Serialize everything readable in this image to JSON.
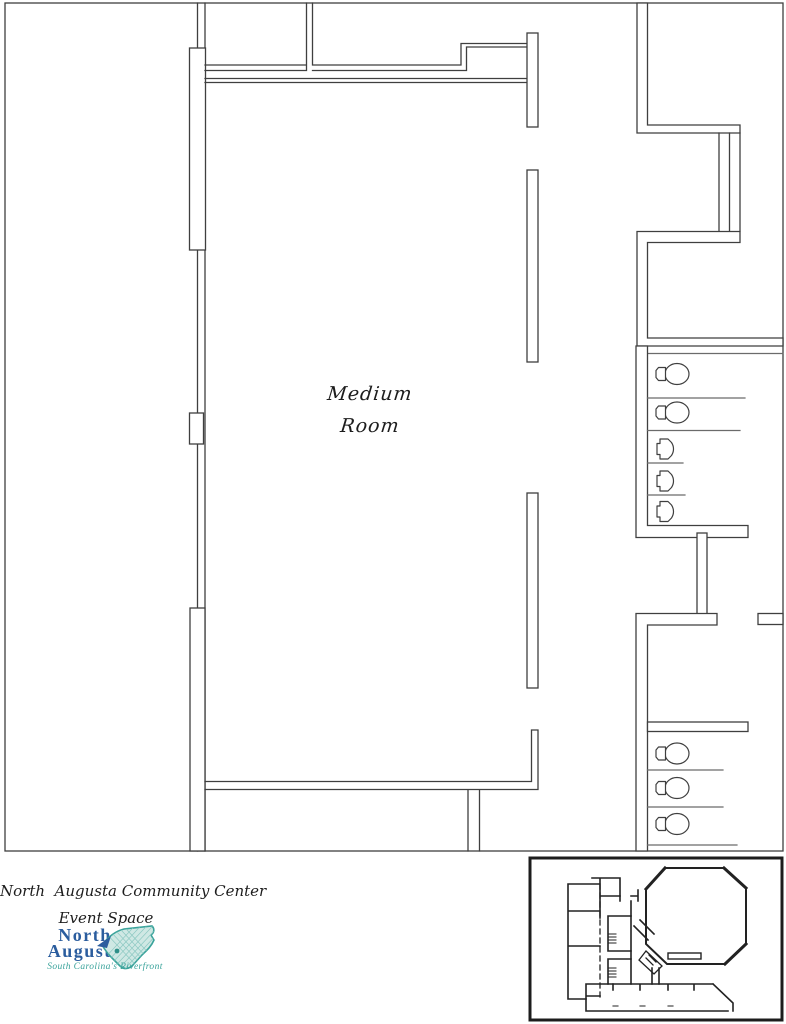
{
  "plan": {
    "room_label": {
      "line1": "Medium",
      "line2": "Room"
    },
    "fixtures": {
      "upper_restroom": {
        "toilets": 2,
        "urinals": 3
      },
      "lower_restroom": {
        "toilets": 3
      }
    },
    "colors": {
      "wall": "#3f3f3f",
      "background": "#ffffff"
    }
  },
  "title_block": {
    "line1": "North  Augusta Community Center",
    "line2": "Event Space"
  },
  "logo": {
    "line1": "North",
    "line2": "Augusta",
    "tagline": "South Carolina's Riverfront",
    "colors": {
      "name_blue": "#2b5d9e",
      "teal": "#3aa39b",
      "state_fill": "#cfe8e4"
    }
  }
}
